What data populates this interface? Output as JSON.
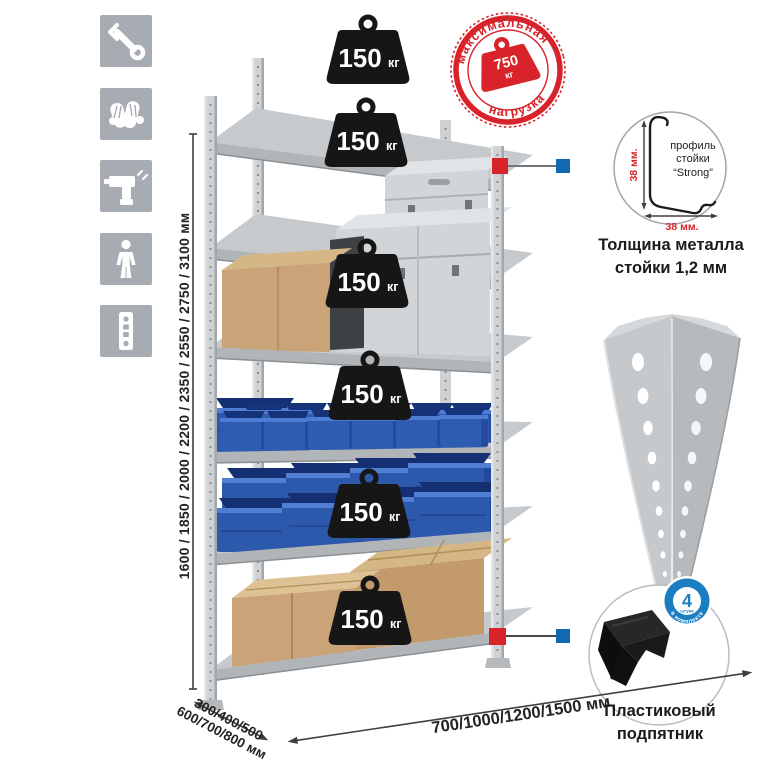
{
  "icons": {
    "tile_color": "#a7acb2",
    "items": [
      {
        "name": "wrench"
      },
      {
        "name": "gloves"
      },
      {
        "name": "drill"
      },
      {
        "name": "person"
      },
      {
        "name": "level-strip"
      }
    ]
  },
  "rack": {
    "shelves": [
      {
        "load": "150",
        "unit": "кг"
      },
      {
        "load": "150",
        "unit": "кг"
      },
      {
        "load": "150",
        "unit": "кг"
      },
      {
        "load": "150",
        "unit": "кг"
      },
      {
        "load": "150",
        "unit": "кг"
      },
      {
        "load": "150",
        "unit": "кг"
      }
    ]
  },
  "stamp": {
    "arc_top": "максимальная",
    "arc_bottom": "нагрузка",
    "value": "750",
    "unit": "кг",
    "color": "#d8232a"
  },
  "dimensions": {
    "height": "1600 / 1850 / 2000 / 2200 / 2350 / 2550 / 2750 / 3100 мм",
    "depth_line1": "300/400/500",
    "depth_line2": "600/700/800 мм",
    "width": "700/1000/1200/1500 мм"
  },
  "profile_detail": {
    "line1": "профиль",
    "line2": "стойки",
    "line3": "“Strong”",
    "dim_v": "38 мм.",
    "dim_h": "38 мм.",
    "caption1": "Толщина металла",
    "caption2": "стойки 1,2 мм"
  },
  "foot_detail": {
    "caption1": "Пластиковый",
    "caption2": "подпятник",
    "badge_count": "4",
    "badge_small": "штуки",
    "badge_arc": "в комплекте",
    "badge_color": "#1b7ec2"
  },
  "colors": {
    "stamp_red": "#d8232a",
    "callout_red": "#d8232a",
    "callout_blue": "#1467b3",
    "bin_blue": "#2e5cb0",
    "metal": "#c9ccce",
    "weight_black": "#161616"
  }
}
